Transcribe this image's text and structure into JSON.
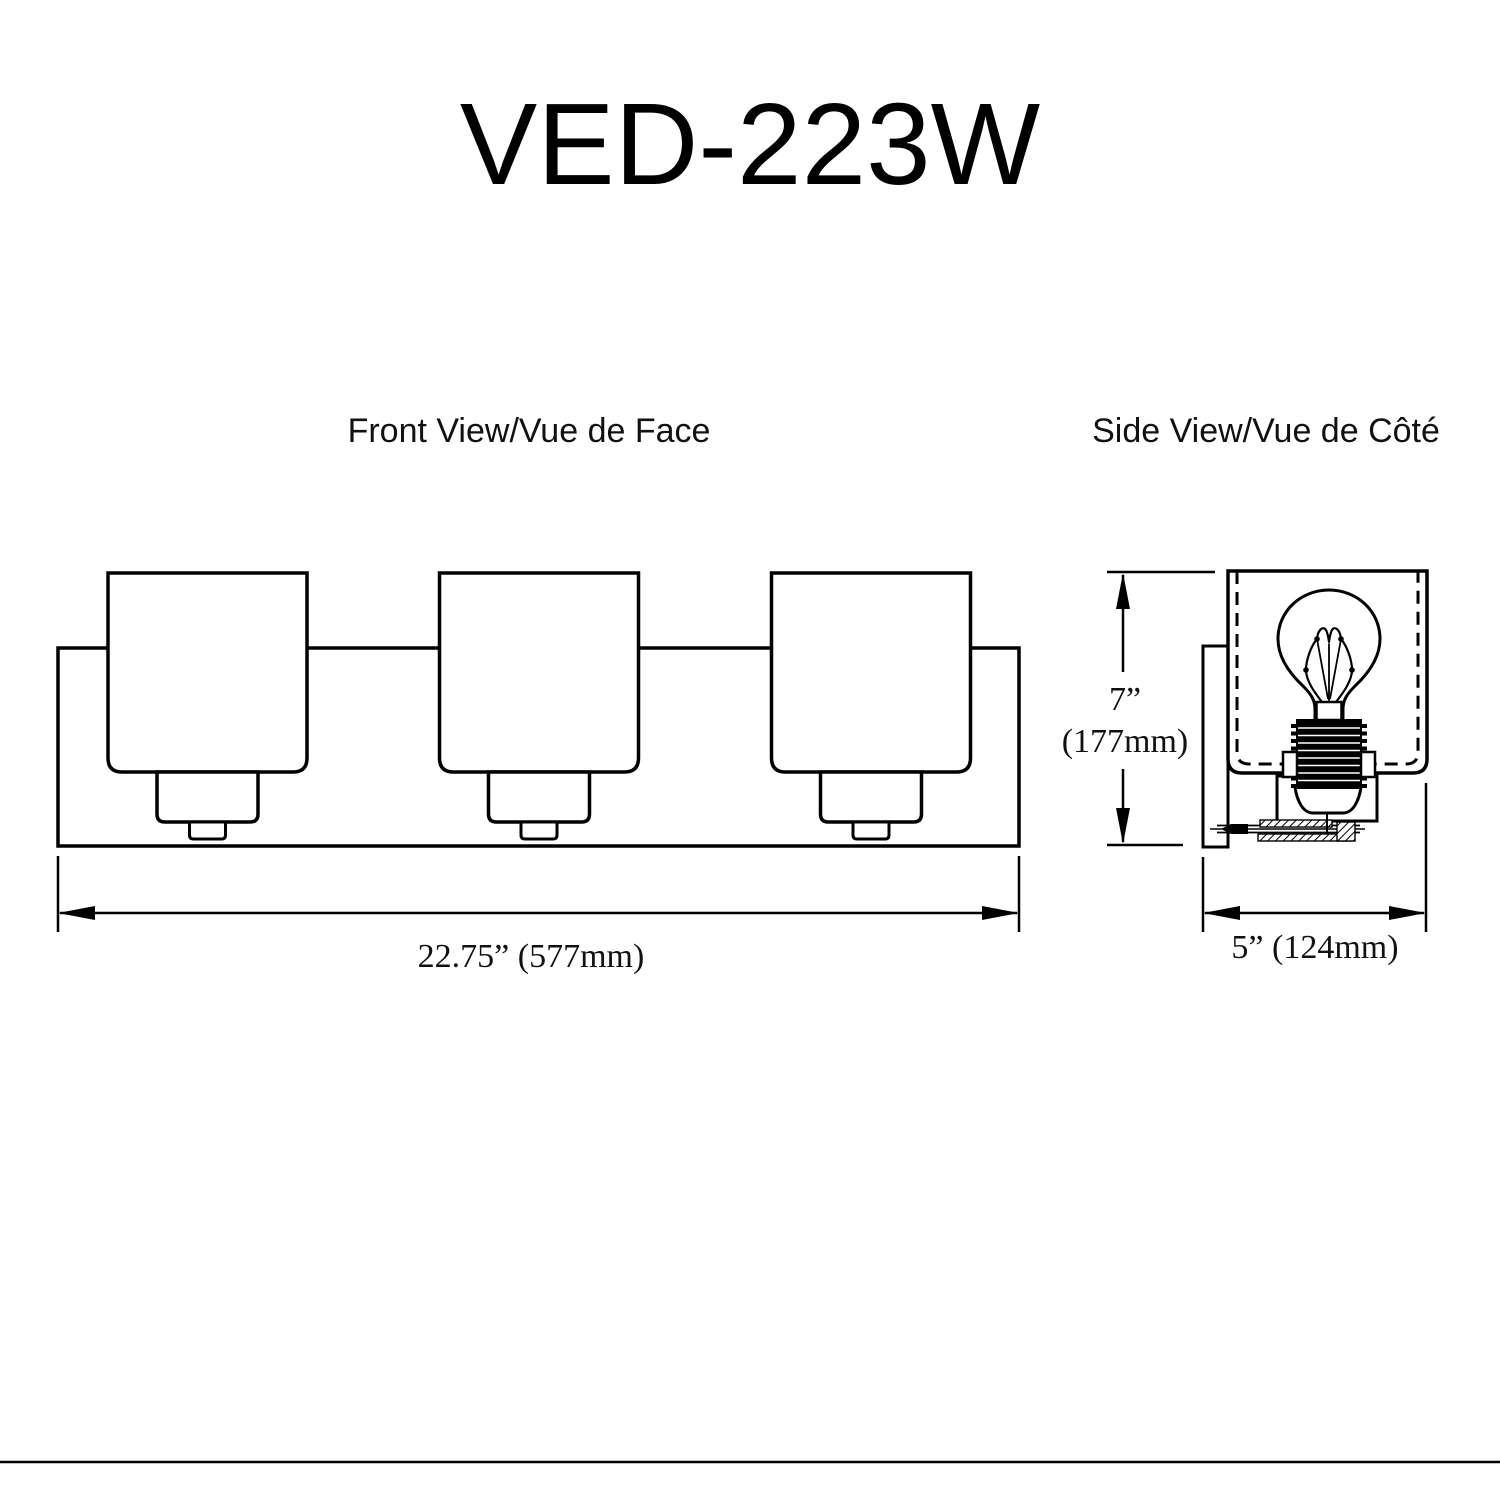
{
  "title": "VED-223W",
  "views": {
    "front": {
      "label": "Front View/Vue de Face",
      "light_count": 3
    },
    "side": {
      "label": "Side View/Vue de Côté"
    }
  },
  "dimensions": {
    "front_width": {
      "label": "22.75” (577mm)",
      "inches": 22.75,
      "mm": 577
    },
    "side_height": {
      "inches_label": "7”",
      "mm_label": "(177mm)",
      "inches": 7,
      "mm": 177
    },
    "side_depth": {
      "label": "5” (124mm)",
      "inches": 5,
      "mm": 124
    }
  },
  "colors": {
    "line": "#000000",
    "background": "#ffffff"
  }
}
